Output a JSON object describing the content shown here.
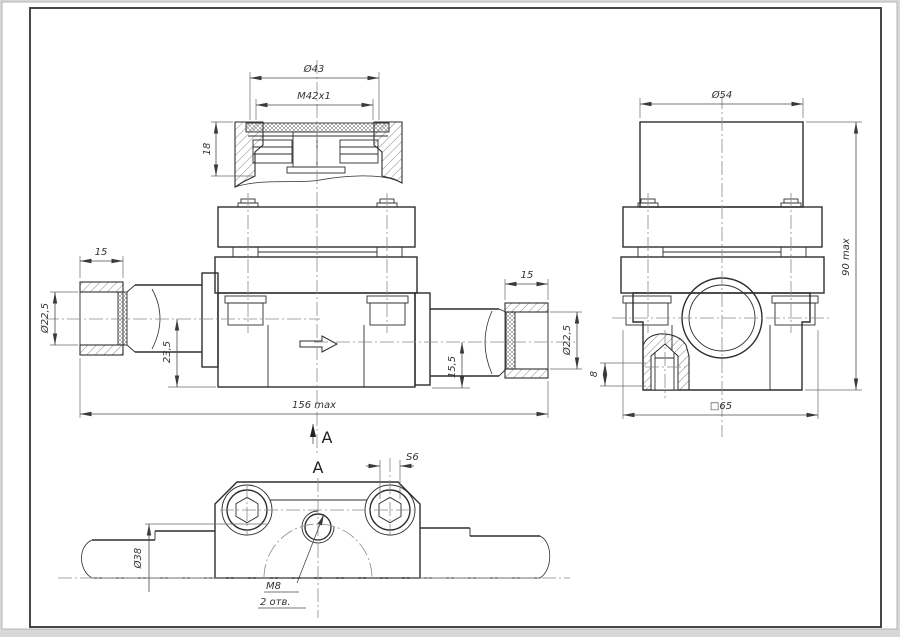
{
  "front_view": {
    "dim_cap_outer_diameter": "Ø43",
    "dim_cap_thread": "M42x1",
    "dim_cap_height": "18",
    "dim_left_fitting_length": "15",
    "dim_left_bore_diameter": "Ø22,5",
    "dim_left_axis_offset": "23,5",
    "dim_right_fitting_length": "15",
    "dim_right_axis_offset": "15,5",
    "dim_right_bore_diameter": "Ø22,5",
    "dim_overall_length": "156 max",
    "section_view_label": "A"
  },
  "side_view": {
    "dim_cap_diameter": "Ø54",
    "dim_overall_height": "90 max",
    "dim_boss_height": "8",
    "dim_body_square": "□65"
  },
  "bottom_view": {
    "view_label": "A",
    "dim_hex_socket_across_flats": "S6",
    "dim_body_diameter": "Ø38",
    "dim_mounting_thread": "M8",
    "dim_mounting_hole_count": "2 отв."
  },
  "colors": {
    "paper": "#ffffff",
    "line": "#2e2e2e",
    "dimension": "#4a4a4a",
    "centerline": "#8a8a8a"
  }
}
